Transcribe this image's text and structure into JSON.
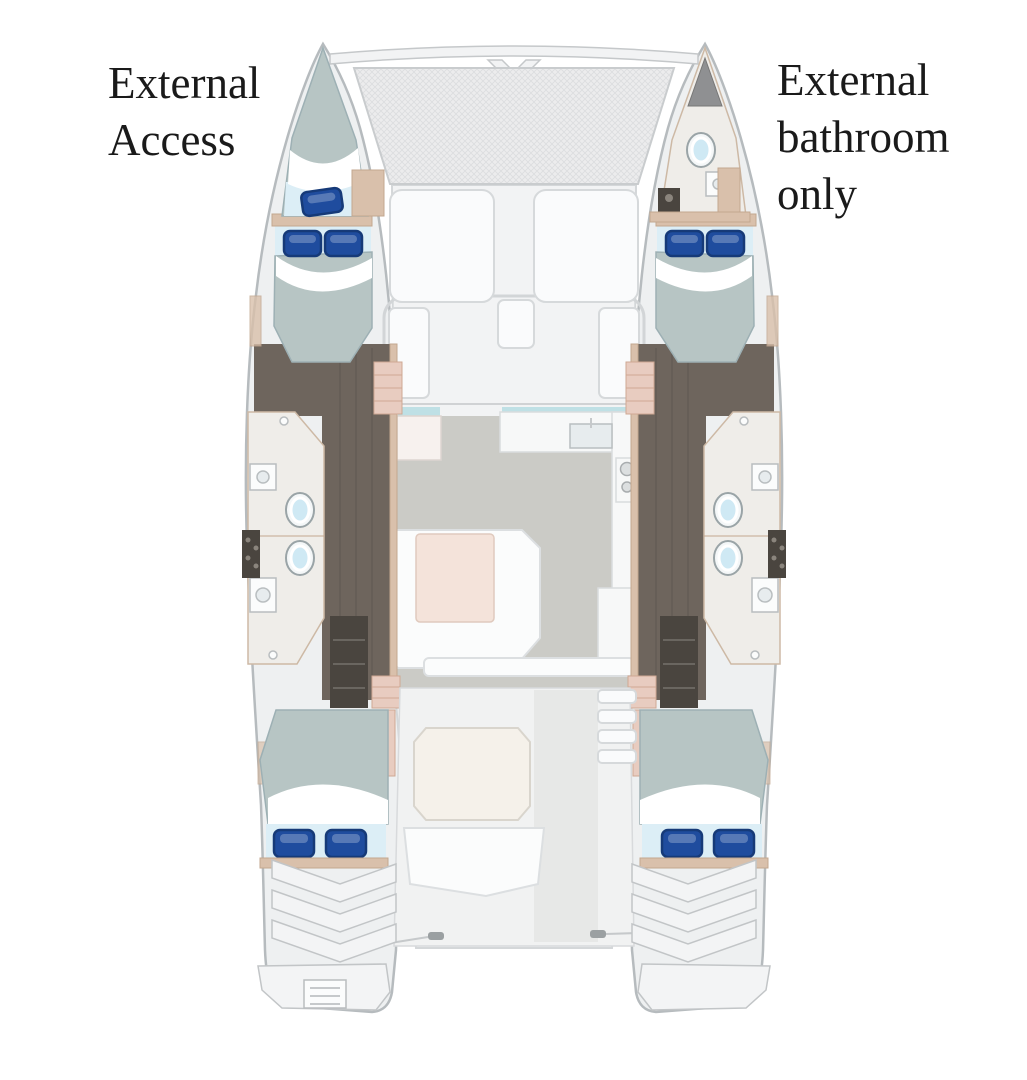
{
  "annotations": {
    "left": {
      "lines": [
        "External",
        "Access"
      ]
    },
    "right": {
      "lines": [
        "External",
        "bathroom",
        "only"
      ]
    }
  },
  "plan": {
    "vessel": "catamaran-floor-plan",
    "rooms": [
      "port-bow-berth",
      "starboard-bow-bathroom",
      "port-forward-cabin",
      "starboard-forward-cabin",
      "port-bathrooms",
      "starboard-bathrooms",
      "saloon-galley",
      "saloon-dinette",
      "cockpit",
      "port-aft-cabin",
      "starboard-aft-cabin"
    ],
    "icons": [
      "toilet-icon",
      "sink-icon",
      "stove-icon",
      "pillow-icon",
      "ladder-icon",
      "trampoline-mesh"
    ]
  },
  "colors": {
    "background": "#ffffff",
    "text": "#1a1a1a",
    "hull_fill": "#eef0f1",
    "hull_outline": "#b6bbbe",
    "deck": "#f2f3f4",
    "mattress": "#b7c5c4",
    "sheet": "#dceef6",
    "pillow": "#1f4c9e",
    "pillow_dark": "#163a78",
    "wood": "#6e655d",
    "trim": "#d9c0ab",
    "bath": "#efede9",
    "toilet": "#cfe9f4",
    "saloon_floor": "#cbcbc6",
    "table": "#f4e3da",
    "window": "#bfe0e5"
  }
}
